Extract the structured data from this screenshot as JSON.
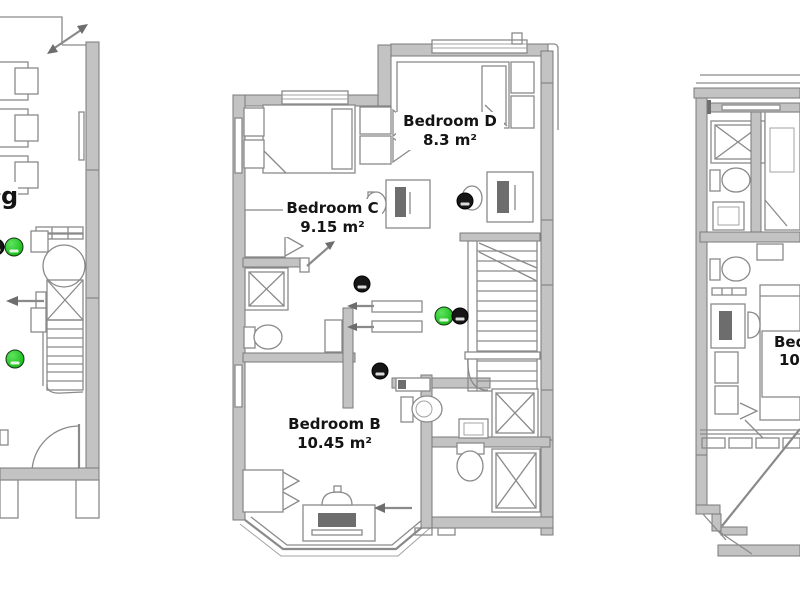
{
  "meta": {
    "type": "architectural-floor-plan",
    "views": 3
  },
  "colors": {
    "background": "#ffffff",
    "line": "#8a8a8a",
    "wall_fill": "#c3c3c3",
    "label_text": "#141414",
    "sensor_green": "#1fbf1f",
    "sensor_black": "#161616"
  },
  "plans": {
    "left": {
      "title": "left-plan-fragment",
      "partial_text": "g"
    },
    "middle": {
      "title": "middle-plan",
      "rooms": [
        {
          "id": "bedroom-d",
          "name": "Bedroom D",
          "area": "8.3 m²"
        },
        {
          "id": "bedroom-c",
          "name": "Bedroom C",
          "area": "9.15 m²"
        },
        {
          "id": "bedroom-b",
          "name": "Bedroom B",
          "area": "10.45 m²"
        }
      ]
    },
    "right": {
      "title": "right-plan-fragment",
      "partial_text_line1": "Bed",
      "partial_text_line2": "10"
    }
  },
  "sensors": [
    {
      "plan": "left",
      "color": "green",
      "x": 14,
      "y": 247
    },
    {
      "plan": "left",
      "color": "black",
      "x": -4,
      "y": 247
    },
    {
      "plan": "left",
      "color": "green",
      "x": 15,
      "y": 359
    },
    {
      "plan": "middle",
      "color": "black",
      "x": 465,
      "y": 201
    },
    {
      "plan": "middle",
      "color": "black",
      "x": 362,
      "y": 284
    },
    {
      "plan": "middle",
      "color": "green",
      "x": 444,
      "y": 316
    },
    {
      "plan": "middle",
      "color": "black",
      "x": 460,
      "y": 316
    },
    {
      "plan": "middle",
      "color": "black",
      "x": 380,
      "y": 371
    }
  ]
}
